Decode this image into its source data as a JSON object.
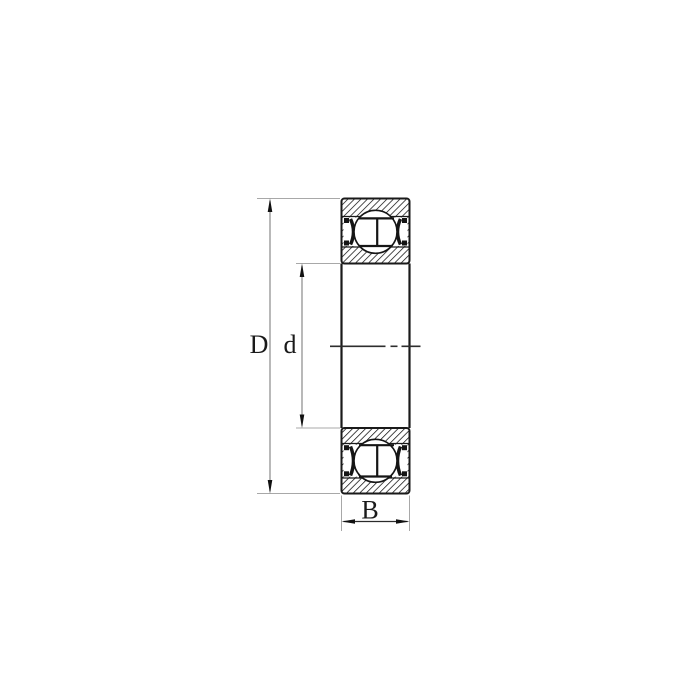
{
  "diagram": {
    "kind": "bearing-cross-section",
    "dimensions": {
      "outer_diameter": {
        "label": "D"
      },
      "bore_diameter": {
        "label": "d"
      },
      "width": {
        "label": "B"
      }
    },
    "colors": {
      "line": "#1a1a1a",
      "hatch": "#161616",
      "dimension_line": "#8a8a8a",
      "extension_line": "#a8a8a8",
      "background": "#ffffff"
    }
  }
}
